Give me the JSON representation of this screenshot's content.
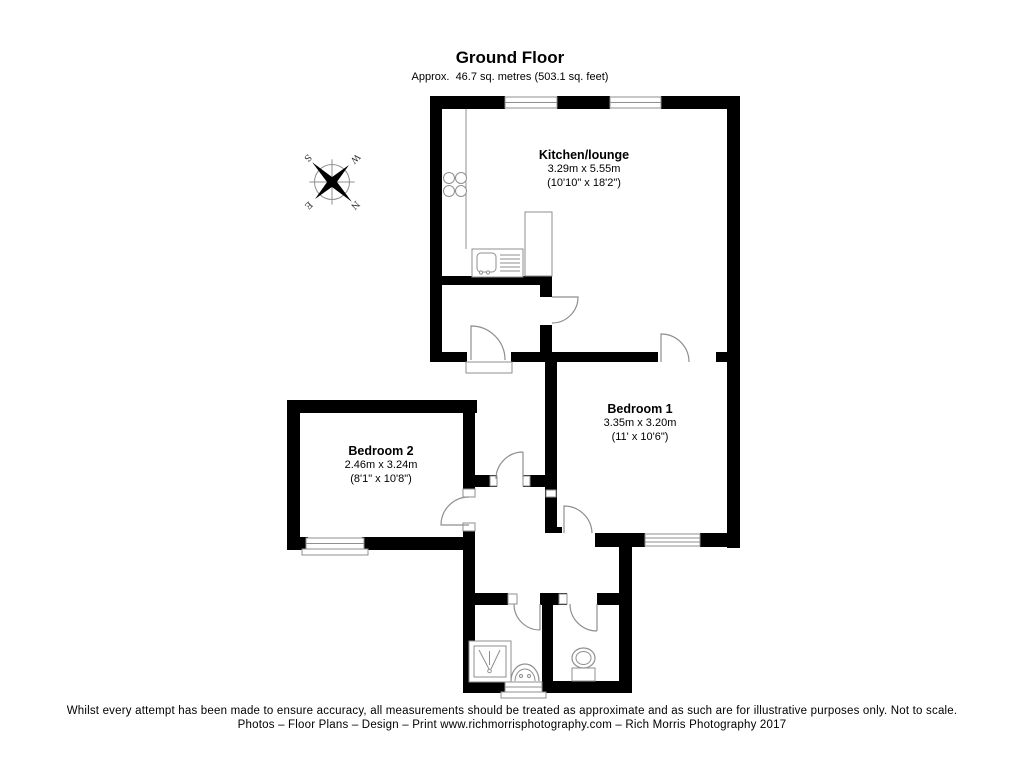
{
  "title": {
    "heading": "Ground Floor",
    "subheading": "Approx.  46.7 sq. metres (503.1 sq. feet)"
  },
  "rooms": {
    "kitchen": {
      "name": "Kitchen/lounge",
      "metric": "3.29m x 5.55m",
      "imperial": "(10'10\" x 18'2\")"
    },
    "bedroom1": {
      "name": "Bedroom 1",
      "metric": "3.35m x 3.20m",
      "imperial": "(11' x 10'6\")"
    },
    "bedroom2": {
      "name": "Bedroom 2",
      "metric": "2.46m x 3.24m",
      "imperial": "(8'1\" x 10'8\")"
    }
  },
  "compass": {
    "n": "N",
    "s": "S",
    "e": "E",
    "w": "W"
  },
  "footer": {
    "line1": "Whilst every attempt has been made to ensure accuracy, all measurements should be treated as approximate and as such are for illustrative purposes only. Not to scale.",
    "line2": "Photos – Floor Plans – Design – Print www.richmorrisphotography.com – Rich Morris Photography 2017"
  },
  "colors": {
    "wall": "#000000",
    "line": "#8f8f8f",
    "text": "#000000"
  }
}
